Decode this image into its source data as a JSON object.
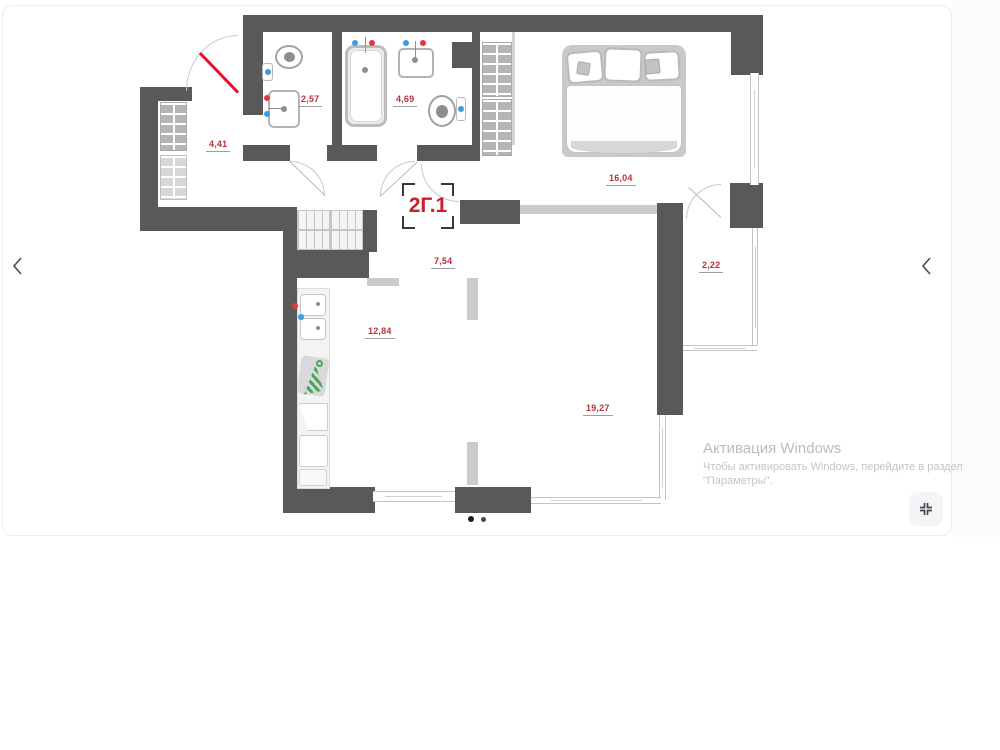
{
  "plan": {
    "code": "2Г.1",
    "rooms": [
      {
        "id": "hallway",
        "area": "4,41"
      },
      {
        "id": "bathroom-small",
        "area": "2,57"
      },
      {
        "id": "bathroom-large",
        "area": "4,69"
      },
      {
        "id": "bedroom",
        "area": "16,04"
      },
      {
        "id": "corridor",
        "area": "7,54"
      },
      {
        "id": "balcony",
        "area": "2,22"
      },
      {
        "id": "kitchen",
        "area": "12,84"
      },
      {
        "id": "living-room",
        "area": "19,27"
      }
    ]
  },
  "carousel": {
    "prev_icon": "chevron-left",
    "next_icon": "chevron-left",
    "dots_count": 2,
    "fullscreen_icon": "collapse-arrows"
  },
  "watermark": {
    "title": "Активация Windows",
    "line1": "Чтобы активировать Windows, перейдите в раздел",
    "line2": "\"Параметры\"."
  },
  "colors": {
    "wall": "#59595b",
    "room_label": "#b8323c",
    "plan_code": "#c8202d",
    "entry_door": "#e8112d",
    "hot_water_dot": "#e03a36",
    "cold_water_dot": "#3f9be0",
    "watermark_text": "#b8bdc3"
  }
}
